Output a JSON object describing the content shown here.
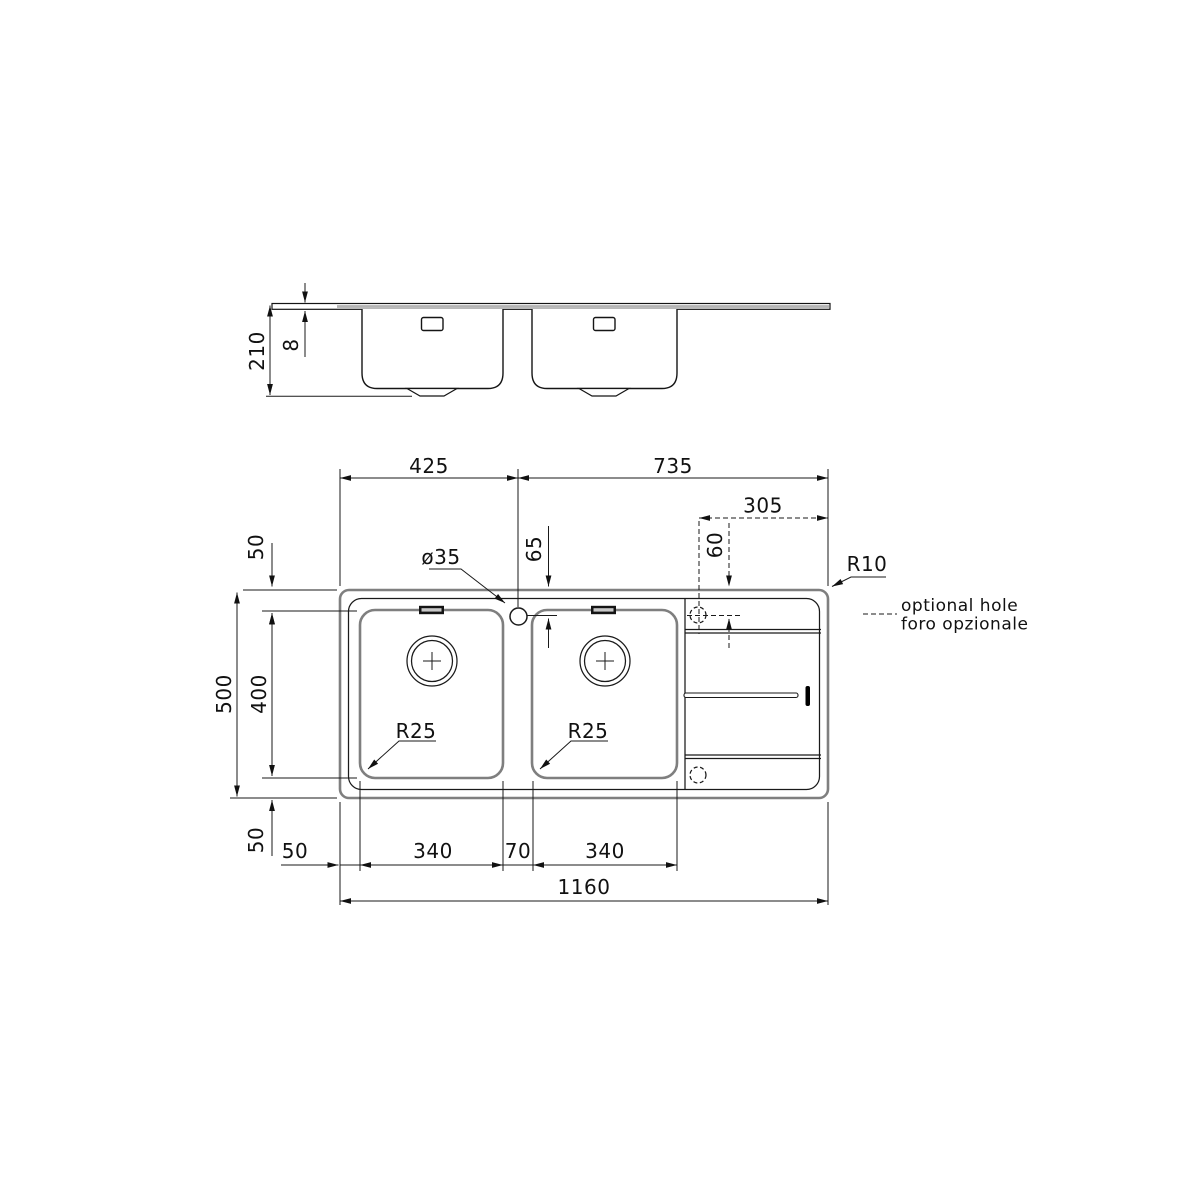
{
  "drawing_type": "sink technical drawing",
  "colors": {
    "background": "#ffffff",
    "dimension_lines": "#1a1a1a",
    "structure_lines": "#7f7f7f",
    "section_fill": "#b4b4b4",
    "text": "#111111"
  },
  "section_view": {
    "overall_height": "210",
    "flange_thickness": "8"
  },
  "plan_view": {
    "top": {
      "left_section_width": "425",
      "right_section_width": "735",
      "optional_hole_offset_x": "305"
    },
    "holes": {
      "tap_hole_diameter": "ø35",
      "tap_hole_offset_y": "65",
      "optional_hole_offset_y": "60"
    },
    "left": {
      "rim_top": "50",
      "bowl_depth": "400",
      "overall_depth": "500",
      "rim_bottom": "50"
    },
    "bottom": {
      "rim_left": "50",
      "bowl1_width": "340",
      "bowl_gap": "70",
      "bowl2_width": "340",
      "overall_width": "1160"
    },
    "radii": {
      "bowl_left_corner": "R25",
      "bowl_right_corner": "R25",
      "rim_corner": "R10"
    }
  },
  "legend": {
    "line1": "optional hole",
    "line2": "foro opzionale"
  }
}
